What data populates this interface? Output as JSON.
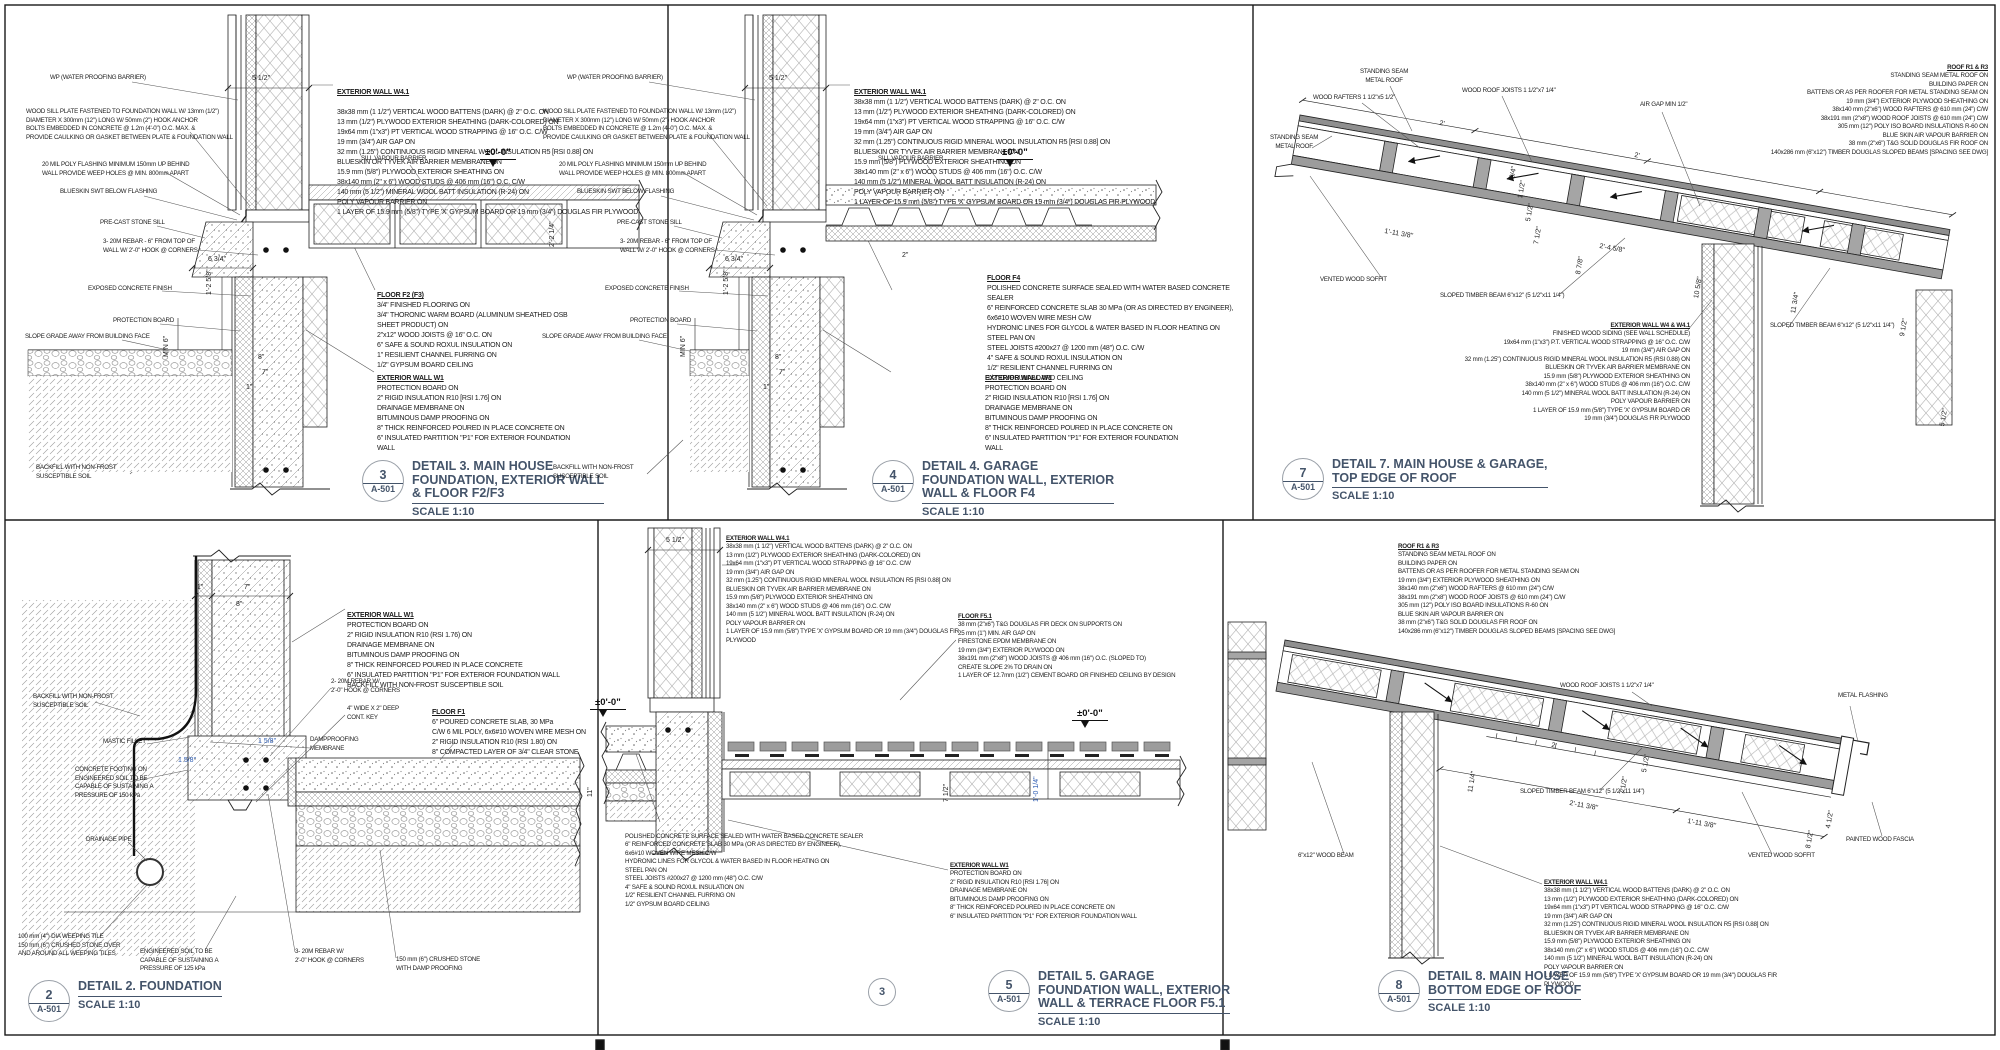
{
  "colors": {
    "line": "#1a1a1a",
    "title": "#44546A",
    "dim_blue": "#2e5db3",
    "metal_gray": "#8f8f8f",
    "deck_gray": "#9c9c9c"
  },
  "assemblies": {
    "wall_w41": {
      "title": "EXTERIOR WALL W4.1",
      "body": "38x38 mm (1 1/2\") VERTICAL WOOD BATTENS (DARK) @ 2\" O.C. ON\n13 mm (1/2\") PLYWOOD EXTERIOR SHEATHING (DARK-COLORED) ON\n19x64 mm (1\"x3\") PT VERTICAL WOOD STRAPPING @ 16\" O.C. C/W\n19 mm (3/4\") AIR GAP ON\n32 mm (1.25\") CONTINUOUS RIGID MINERAL WOOL INSULATION R5 [RSI 0.88] ON\nBLUESKIN OR TYVEK AIR BARRIER MEMBRANE ON\n15.9 mm (5/8\") PLYWOOD EXTERIOR SHEATHING ON\n38x140 mm (2\" x 6\") WOOD STUDS @ 406 mm (16\") O.C. C/W\n140 mm (5 1/2\") MINERAL WOOL BATT INSULATION (R-24) ON\nPOLY VAPOUR BARRIER ON\n1 LAYER OF 15.9 mm (5/8\") TYPE 'X' GYPSUM BOARD OR 19 mm (3/4\") DOUGLAS FIR PLYWOOD"
    },
    "wall_w4": {
      "title": "EXTERIOR WALL W4 & W4.1",
      "body": "FINISHED WOOD SIDING (SEE WALL SCHEDULE)\n19x64 mm (1\"x3\") P.T. VERTICAL WOOD STRAPPING @ 16\" O.C. C/W\n19 mm (3/4\") AIR GAP ON\n32 mm (1.25\") CONTINUOUS RIGID MINERAL WOOL INSULATION R5 (RSI 0.88) ON\nBLUESKIN OR TYVEK AIR BARRIER MEMBRANE ON\n15.9 mm (5/8\") PLYWOOD EXTERIOR SHEATHING ON\n38x140 mm (2\" x 6\") WOOD STUDS @ 406 mm (16\") O.C. C/W\n140 mm (5 1/2\") MINERAL WOOL BATT INSULATION (R-24) ON\nPOLY VAPOUR BARRIER ON\n1 LAYER OF 15.9 mm (5/8\") TYPE 'X' GYPSUM BOARD OR\n19 mm (3/4\") DOUGLAS FIR PLYWOOD"
    },
    "wall_w1": {
      "title": "EXTERIOR WALL W1",
      "body": "PROTECTION BOARD ON\n2\" RIGID INSULATION R10 [RSI 1.76] ON\nDRAINAGE MEMBRANE ON\nBITUMINOUS DAMP PROOFING ON\n8\" THICK REINFORCED POURED IN PLACE CONCRETE ON\n6\" INSULATED PARTITION \"P1\" FOR EXTERIOR FOUNDATION WALL"
    },
    "wall_w1b": {
      "title": "EXTERIOR WALL W1",
      "body": "PROTECTION BOARD ON\n2\" RIGID INSULATION R10 (RSI 1.76) ON\nDRAINAGE MEMBRANE ON\nBITUMINOUS DAMP PROOFING ON\n8\" THICK REINFORCED POURED IN PLACE CONCRETE\n6\" INSULATED PARTITION \"P1\" FOR EXTERIOR FOUNDATION WALL\nBACKFILL WITH NON-FROST SUSCEPTIBLE SOIL"
    },
    "floor_f2": {
      "title": "FLOOR F2 (F3)",
      "body": "3/4\" FINISHED FLOORING ON\n3/4\" THORONIC WARM BOARD (ALUMINUM SHEATHED OSB SHEET PRODUCT) ON\n2\"x12\" WOOD JOISTS @ 16\" O.C. ON\n6\" SAFE & SOUND ROXUL INSULATION ON\n1\" RESILIENT CHANNEL FURRING ON\n1/2\" GYPSUM BOARD CEILING"
    },
    "floor_f4": {
      "title": "FLOOR F4",
      "body": "POLISHED CONCRETE SURFACE SEALED WITH WATER BASED CONCRETE SEALER\n6\" REINFORCED CONCRETE SLAB 30 MPa (OR AS DIRECTED BY ENGINEER),\n6x6#10 WOVEN WIRE MESH C/W\nHYDRONIC LINES FOR GLYCOL & WATER BASED IN FLOOR HEATING ON\nSTEEL PAN ON\nSTEEL JOISTS #200x27 @ 1200 mm (48\") O.C. C/W\n4\" SAFE & SOUND ROXUL INSULATION ON\n1/2\" RESILIENT CHANNEL FURRING ON\n1/2\" GYPSUM BOARD CEILING"
    },
    "floor_f1": {
      "title": "FLOOR F1",
      "body": "6\" POURED CONCRETE SLAB, 30 MPa\nC/W 6 MIL POLY, 6x6#10 WOVEN WIRE MESH ON\n2\" RIGID INSULATION R10 (RSI 1.80) ON\n8\" COMPACTED LAYER OF 3/4\" CLEAR STONE"
    },
    "floor_f51": {
      "title": "FLOOR F5.1",
      "body": "38 mm (2\"x6\") T&G DOUGLAS FIR DECK ON SUPPORTS ON\n25 mm (1\") MIN. AIR GAP ON\nFIRESTONE EPDM MEMBRANE ON\n19 mm (3/4\") EXTERIOR PLYWOOD ON\n38x191 mm (2\"x8\") WOOD JOISTS @ 406 mm (16\") O.C. (SLOPED TO)\nCREATE SLOPE 2% TO DRAIN ON\n1 LAYER OF 12.7mm (1/2\") CEMENT BOARD OR FINISHED CEILING BY DESIGN"
    },
    "roof_r1": {
      "title": "ROOF R1 & R3",
      "body": "STANDING SEAM METAL ROOF ON\nBUILDING PAPER ON\nBATTENS OR AS PER ROOFER FOR METAL STANDING SEAM ON\n19 mm (3/4\") EXTERIOR PLYWOOD SHEATHING ON\n38x140 mm (2\"x6\") WOOD RAFTERS @ 610 mm (24\") C/W\n38x191 mm (2\"x8\") WOOD ROOF JOISTS @ 610 mm (24\") C/W\n305 mm (12\") POLY ISO BOARD INSULATIONS R-60 ON\nBLUE SKIN AIR VAPOUR BARRIER ON\n38 mm (2\"x6\") T&G SOLID DOUGLAS FIR ROOF ON\n140x286 mm (6\"x12\") TIMBER DOUGLAS SLOPED BEAMS [SPACING SEE DWG]"
    }
  },
  "shared": {
    "wp": "WP (WATER PROOFING BARRIER)",
    "sill_plate": "WOOD SILL PLATE FASTENED TO FOUNDATION WALL W/ 13mm (1/2\")\nDIAMETER X 300mm (12\") LONG W/ 50mm (2\") HOOK ANCHOR\nBOLTS EMBEDDED IN CONCRETE @ 1.2m (4'-0\") O.C. MAX. &\nPROVIDE CAULKING OR GASKET BETWEEN PLATE & FOUNDATION WALL",
    "poly_flashing": "20 MIL POLY FLASHING MINIMUM 150mm UP BEHIND\nWALL PROVIDE WEEP HOLES @ MIN. 800mm APART",
    "blueskin": "BLUESKIN SWT BELOW FLASHING",
    "precast": "PRE-CAST STONE SILL",
    "rebar_top": "3- 20M REBAR - 6\" FROM TOP OF\nWALL W/ 2'-0\" HOOK @ CORNERS",
    "exposed": "EXPOSED CONCRETE FINISH",
    "protection": "PROTECTION BOARD",
    "slope_grade": "SLOPE GRADE AWAY FROM BUILDING FACE",
    "backfill": "BACKFILL WITH NON-FROST\nSUSCEPTIBLE SOIL",
    "sill_vb": "SILL VAPOUR BARRIER",
    "level_zero": "±0'-0\""
  },
  "panels": {
    "d3": {
      "num": "3",
      "ref": "A-501",
      "scale": "SCALE 1:10",
      "title": "DETAIL 3. MAIN HOUSE\nFOUNDATION, EXTERIOR WALL\n& FLOOR F2/F3",
      "dims": {
        "w": "5 1/2\"",
        "sill": "6 3/4\"",
        "h1": "1'-2 5/8\"",
        "min6": "MIN 6\"",
        "d8": "8\"",
        "d7": "7\"",
        "d1": "1\"",
        "cav": "2'-2 1/4\""
      }
    },
    "d4": {
      "num": "4",
      "ref": "A-501",
      "scale": "SCALE 1:10",
      "title": "DETAIL 4. GARAGE\nFOUNDATION WALL, EXTERIOR\nWALL & FLOOR F4",
      "dims": {
        "w": "5 1/2\"",
        "sill": "6 3/4\"",
        "h1": "1'-2 5/8\"",
        "min6": "MIN 6\"",
        "d8": "8\"",
        "d7": "7\"",
        "d1": "1\"",
        "pan": "2\""
      }
    },
    "d7": {
      "num": "7",
      "ref": "A-501",
      "scale": "SCALE 1:10",
      "title": "DETAIL 7. MAIN HOUSE & GARAGE,\nTOP EDGE OF ROOF",
      "labels": {
        "ssmr": "STANDING SEAM\nMETAL ROOF",
        "rafters": "WOOD RAFTERS 1 1/2\"x5 1/2\"",
        "joists": "WOOD ROOF JOISTS 1 1/2\"x7 1/4\"",
        "airgap": "AIR GAP MIN 1/2\"",
        "soffit": "VENTED WOOD SOFFIT",
        "beam": "SLOPED TIMBER BEAM 6\"x12\" (5 1/2\"x11 1/4\")",
        "beam2": "SLOPED TIMBER BEAM 6\"x12\" (5 1/2\"x11 1/4\")"
      },
      "dims": {
        "a": "2'",
        "b": "2'",
        "c": "1'-11 3/8\"",
        "d": "2'-4 5/8\"",
        "e": "8 7/8\"",
        "f": "10 5/8\"",
        "g": "11 3/4\"",
        "h": "9 1/2\"",
        "i": "5 1/2\"",
        "j": "7 1/2\"",
        "k": "3/4\"",
        "l": "1 1/2\"",
        "m": "5 1/2\""
      }
    },
    "d2": {
      "num": "2",
      "ref": "A-501",
      "scale": "SCALE 1:10",
      "title": "DETAIL 2. FOUNDATION",
      "labels": {
        "rebar2": "2- 20M REBAR W/\n2'-0\" HOOK @ CORNERS",
        "key": "4\" WIDE X 2\" DEEP\nCONT. KEY",
        "damp": "DAMPPROOFING\nMEMBRANE",
        "fillet": "MASTIC FILLET",
        "footing": "CONCRETE FOOTING ON\nENGINEERED SOIL TO BE\nCAPABLE OF SUSTAINING A\nPRESSURE OF 150 kPa",
        "drain": "DRAINAGE PIPE",
        "weeping": "100 mm (4\") DIA WEEPING TILE\n150 mm (6\") CRUSHED STONE OVER\nAND AROUND ALL WEEPING TILES",
        "eng": "ENGINEERED SOIL TO BE\nCAPABLE OF SUSTAINING A\nPRESSURE OF 125 kPa",
        "rebar3": "3- 20M REBAR W/\n2'-0\" HOOK @ CORNERS",
        "crushed": "150 mm (6\") CRUSHED STONE\nWITH DAMP PROOFING"
      },
      "dims": {
        "a": "1\"",
        "b": "7\"",
        "c": "8\"",
        "d": "1 5/8\"",
        "e": "1 5/8\""
      }
    },
    "d5": {
      "num": "5",
      "ref": "A-501",
      "scale": "SCALE 1:10",
      "sub_num": "3",
      "title": "DETAIL 5. GARAGE\nFOUNDATION WALL, EXTERIOR\nWALL & TERRACE FLOOR F5.1",
      "dims": {
        "w": "5 1/2\"",
        "a": "11\"",
        "b": "7 1/2\"",
        "c": "1'-0 1/4\""
      }
    },
    "d8": {
      "num": "8",
      "ref": "A-501",
      "scale": "SCALE 1:10",
      "title": "DETAIL 8. MAIN HOUSE\nBOTTOM EDGE OF ROOF",
      "labels": {
        "beam": "SLOPED TIMBER BEAM 6\"x12\" (5 1/2\"x11 1/4\")",
        "beam2": "6\"x12\" WOOD BEAM",
        "soffit": "VENTED WOOD SOFFIT",
        "flashing": "METAL FLASHING",
        "fascia": "PAINTED WOOD FASCIA",
        "joists": "WOOD ROOF JOISTS 1 1/2\"x7 1/4\""
      },
      "dims": {
        "a": "2'",
        "b": "2'-11 3/8\"",
        "c": "1'-11 3/8\"",
        "d": "11 1/4\"",
        "e": "5 1/2\"",
        "f": "7 1/2\"",
        "g": "4 1/2\"",
        "h": "8 1/2\""
      }
    }
  }
}
